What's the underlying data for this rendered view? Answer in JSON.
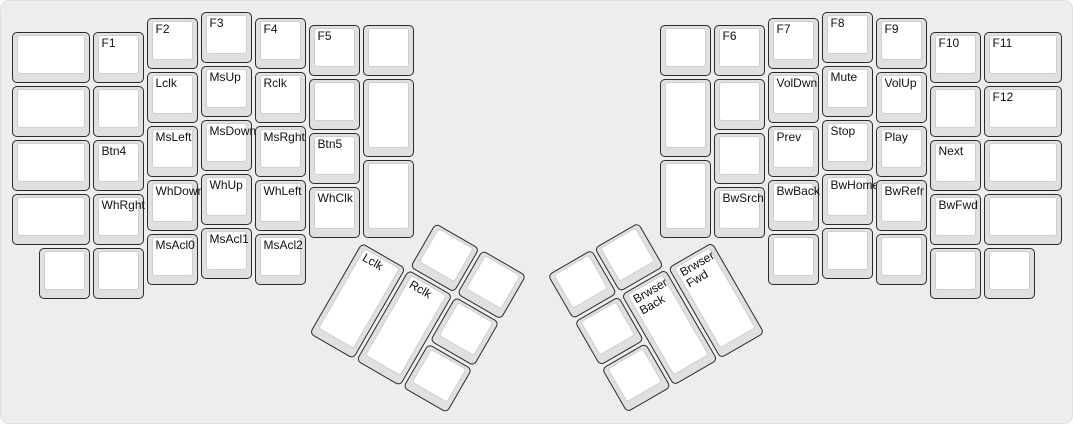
{
  "keyboard": {
    "name": "ergodox-function-layer",
    "colors": {
      "case": "#ededed",
      "key_side": "#e0e0e0",
      "key_face": "#ffffff",
      "key_border": "#2b2b2b",
      "label_text": "#111111"
    },
    "main_keys": [
      [
        0,
        0.375,
        1.5,
        1,
        ""
      ],
      [
        0,
        1.375,
        1.5,
        1,
        ""
      ],
      [
        0,
        2.375,
        1.5,
        1,
        ""
      ],
      [
        0,
        3.375,
        1.5,
        1,
        ""
      ],
      [
        1.5,
        0.375,
        1,
        1,
        "F1"
      ],
      [
        1.5,
        1.375,
        1,
        1,
        ""
      ],
      [
        1.5,
        2.375,
        1,
        1,
        "Btn4"
      ],
      [
        1.5,
        3.375,
        1,
        1,
        "WhRght"
      ],
      [
        2.5,
        0.125,
        1,
        1,
        "F2"
      ],
      [
        2.5,
        1.125,
        1,
        1,
        "Lclk"
      ],
      [
        2.5,
        2.125,
        1,
        1,
        "MsLeft"
      ],
      [
        2.5,
        3.125,
        1,
        1,
        "WhDown"
      ],
      [
        2.5,
        4.125,
        1,
        1,
        "MsAcl0"
      ],
      [
        3.5,
        0,
        1,
        1,
        "F3"
      ],
      [
        3.5,
        1,
        1,
        1,
        "MsUp"
      ],
      [
        3.5,
        2,
        1,
        1,
        "MsDown"
      ],
      [
        3.5,
        3,
        1,
        1,
        "WhUp"
      ],
      [
        3.5,
        4,
        1,
        1,
        "MsAcl1"
      ],
      [
        4.5,
        0.125,
        1,
        1,
        "F4"
      ],
      [
        4.5,
        1.125,
        1,
        1,
        "Rclk"
      ],
      [
        4.5,
        2.125,
        1,
        1,
        "MsRght"
      ],
      [
        4.5,
        3.125,
        1,
        1,
        "WhLeft"
      ],
      [
        4.5,
        4.125,
        1,
        1,
        "MsAcl2"
      ],
      [
        5.5,
        0.25,
        1,
        1,
        "F5"
      ],
      [
        5.5,
        1.25,
        1,
        1,
        ""
      ],
      [
        5.5,
        2.25,
        1,
        1,
        "Btn5"
      ],
      [
        5.5,
        3.25,
        1,
        1,
        "WhClk"
      ],
      [
        6.5,
        0.25,
        1,
        1,
        ""
      ],
      [
        6.5,
        1.25,
        1,
        1.5,
        ""
      ],
      [
        6.5,
        2.75,
        1,
        1.5,
        ""
      ],
      [
        0.5,
        4.375,
        1,
        1,
        ""
      ],
      [
        1.5,
        4.375,
        1,
        1,
        ""
      ],
      [
        12,
        0.25,
        1,
        1,
        ""
      ],
      [
        12,
        1.25,
        1,
        1.5,
        ""
      ],
      [
        12,
        2.75,
        1,
        1.5,
        ""
      ],
      [
        13,
        0.25,
        1,
        1,
        "F6"
      ],
      [
        13,
        1.25,
        1,
        1,
        ""
      ],
      [
        13,
        2.25,
        1,
        1,
        ""
      ],
      [
        13,
        3.25,
        1,
        1,
        "BwSrch"
      ],
      [
        14,
        0.125,
        1,
        1,
        "F7"
      ],
      [
        14,
        1.125,
        1,
        1,
        "VolDwn"
      ],
      [
        14,
        2.125,
        1,
        1,
        "Prev"
      ],
      [
        14,
        3.125,
        1,
        1,
        "BwBack"
      ],
      [
        14,
        4.125,
        1,
        1,
        ""
      ],
      [
        15,
        0,
        1,
        1,
        "F8"
      ],
      [
        15,
        1,
        1,
        1,
        "Mute"
      ],
      [
        15,
        2,
        1,
        1,
        "Stop"
      ],
      [
        15,
        3,
        1,
        1,
        "BwHome"
      ],
      [
        15,
        4,
        1,
        1,
        ""
      ],
      [
        16,
        0.125,
        1,
        1,
        "F9"
      ],
      [
        16,
        1.125,
        1,
        1,
        "VolUp"
      ],
      [
        16,
        2.125,
        1,
        1,
        "Play"
      ],
      [
        16,
        3.125,
        1,
        1,
        "BwRefr"
      ],
      [
        16,
        4.125,
        1,
        1,
        ""
      ],
      [
        17,
        0.375,
        1,
        1,
        "F10"
      ],
      [
        17,
        1.375,
        1,
        1,
        ""
      ],
      [
        17,
        2.375,
        1,
        1,
        "Next"
      ],
      [
        17,
        3.375,
        1,
        1,
        "BwFwd"
      ],
      [
        18,
        0.375,
        1.5,
        1,
        "F11"
      ],
      [
        18,
        1.375,
        1.5,
        1,
        "F12"
      ],
      [
        18,
        2.375,
        1.5,
        1,
        ""
      ],
      [
        18,
        3.375,
        1.5,
        1,
        ""
      ],
      [
        17,
        4.375,
        1,
        1,
        ""
      ],
      [
        18,
        4.375,
        1,
        1,
        ""
      ]
    ],
    "clusters": [
      {
        "name": "left-thumb-cluster",
        "rotation": 30,
        "rx": 6.5,
        "ry": 4.25,
        "keys": [
          [
            1,
            -1,
            1,
            1,
            ""
          ],
          [
            2,
            -1,
            1,
            1,
            ""
          ],
          [
            0,
            0,
            1,
            2,
            "Lclk"
          ],
          [
            1,
            0,
            1,
            2,
            "Rclk"
          ],
          [
            2,
            0,
            1,
            1,
            ""
          ],
          [
            2,
            1,
            1,
            1,
            ""
          ]
        ]
      },
      {
        "name": "right-thumb-cluster",
        "rotation": -30,
        "rx": 13,
        "ry": 4.25,
        "keys": [
          [
            -3,
            -1,
            1,
            1,
            ""
          ],
          [
            -2,
            -1,
            1,
            1,
            ""
          ],
          [
            -3,
            0,
            1,
            1,
            ""
          ],
          [
            -2,
            0,
            1,
            2,
            "Brwser Back"
          ],
          [
            -1,
            0,
            1,
            2,
            "Brwser Fwd"
          ],
          [
            -3,
            1,
            1,
            1,
            ""
          ]
        ]
      }
    ]
  }
}
